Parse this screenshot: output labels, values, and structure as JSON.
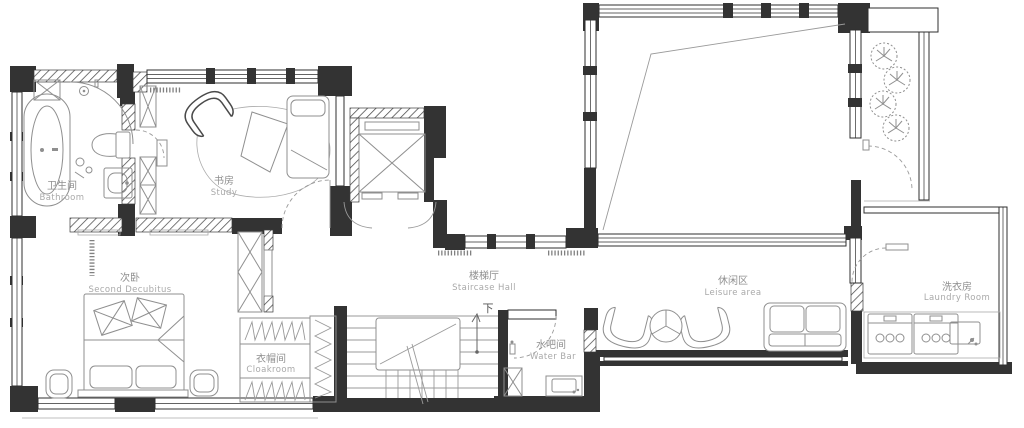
{
  "plan": {
    "type": "residential-floor-plan",
    "colors": {
      "wall": "#333333",
      "furniture": "#8f8f8f",
      "label_zh": "#8f8f8f",
      "label_en": "#a9a9a9",
      "background": "#ffffff"
    },
    "rooms": {
      "bathroom": {
        "zh": "卫生间",
        "en": "Bathroom"
      },
      "study": {
        "zh": "书房",
        "en": "Study"
      },
      "second_bedroom": {
        "zh": "次卧",
        "en": "Second Decubitus"
      },
      "cloakroom": {
        "zh": "衣帽间",
        "en": "Cloakroom"
      },
      "staircase_hall": {
        "zh": "楼梯厅",
        "en": "Staircase Hall"
      },
      "water_bar": {
        "zh": "水吧间",
        "en": "Water Bar"
      },
      "leisure_area": {
        "zh": "休闲区",
        "en": "Leisure area"
      },
      "laundry_room": {
        "zh": "洗衣房",
        "en": "Laundry Room"
      }
    },
    "stairs": {
      "direction_label": "下"
    }
  }
}
